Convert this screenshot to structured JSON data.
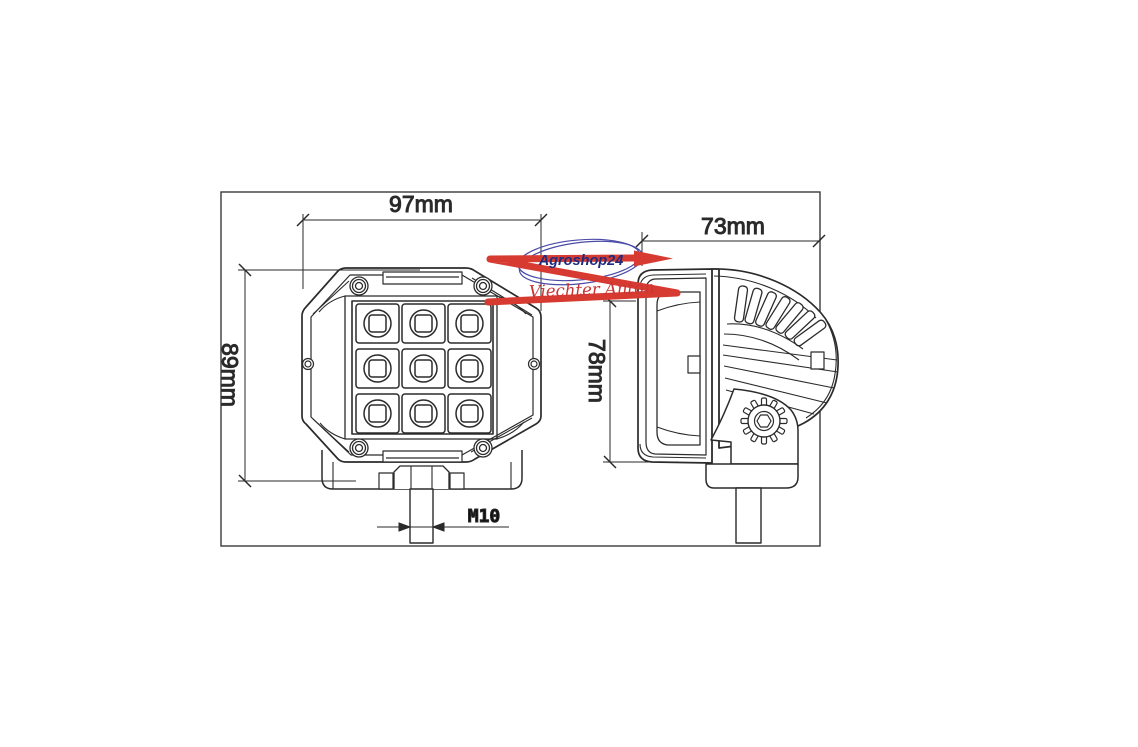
{
  "drawing": {
    "background": "#ffffff",
    "line_color": "#2b2b2b",
    "dimensions": {
      "front_width": "97mm",
      "front_height": "89mm",
      "side_depth": "73mm",
      "side_height": "78mm",
      "thread": "M10"
    },
    "led_grid": "3x3"
  },
  "watermark": {
    "shop": "Agroshop24",
    "signature": "Viechter Anton",
    "ellipse_color": "#4a4aa8",
    "shop_text_color": "#1e2c7e",
    "signature_color": "#cc3433",
    "arrow_color": "#d63a30"
  }
}
